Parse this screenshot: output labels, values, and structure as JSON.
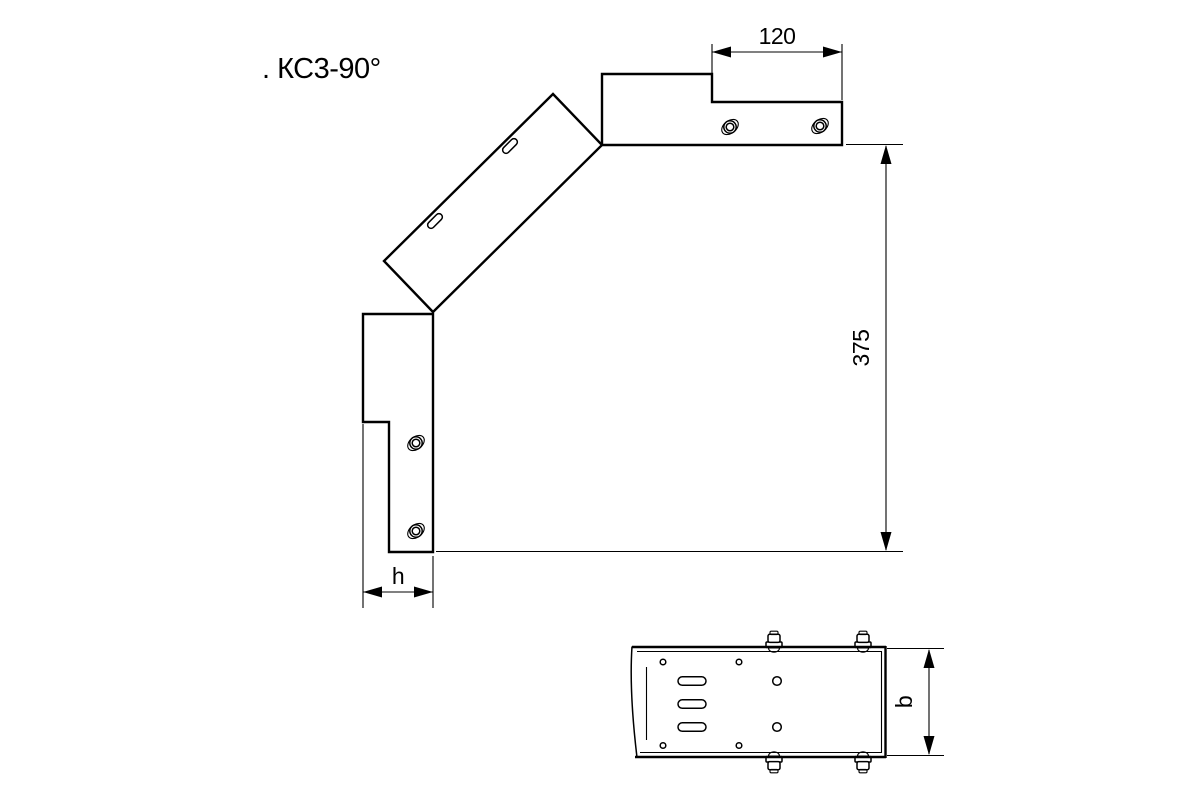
{
  "title": ". КС3-90°",
  "colors": {
    "line": "#000000",
    "background": "#ffffff"
  },
  "dimensions": {
    "top_width": "120",
    "side_height": "375",
    "flange_height": "h",
    "tray_width": "b"
  }
}
